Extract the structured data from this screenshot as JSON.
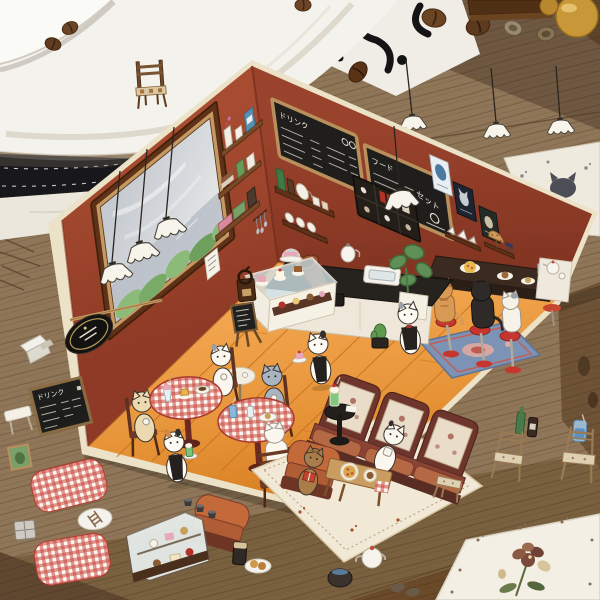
{
  "meta": {
    "type": "photograph",
    "description": "A handmade miniature paper diorama of a cat cafe standing open on a wooden table, surrounded by craft sticker sheets, a large white plate, scattered coffee beans, amber caramels and a black-and-white patterned cloth."
  },
  "diorama": {
    "menu_boards": {
      "drinks_title": "ドリンク",
      "food_title": "フード",
      "set_title": "セット"
    },
    "wall_color": "#9c4430",
    "floor_color": "#e59b3f",
    "card_edge_color": "#efe6cf",
    "left_wall_items": [
      "large window with garden view",
      "three frilled pendant lamps",
      "three wall shelves with books, jars and bottles",
      "black oval coffee sign",
      "small menu paper",
      "hanging utensil rack",
      "leaning wooden rod"
    ],
    "back_wall_items": [
      "two chalkboard menus",
      "shelf with bottles and jug",
      "shelf with cups",
      "dark display cabinet",
      "frilled pendant lamp",
      "three posters",
      "shelf with open books",
      "shelf with table lamp and books"
    ],
    "furniture": [
      "L-shaped service counter with sink",
      "cake display case",
      "gramophone",
      "coffee grinder",
      "monstera plant in white pot",
      "small cactus",
      "standing easel chalkboard",
      "two round tables with red gingham cloth",
      "small white cloth table",
      "wooden chairs",
      "bar counter with red stools",
      "blue floral rug",
      "high-back booth sofa",
      "two orange armchairs",
      "black round side table with melon cream soda",
      "wooden coffee table with pizza",
      "cream floral rug"
    ],
    "cats": [
      {
        "spot": "behind counter",
        "look": "white cat waiter with dark apron"
      },
      {
        "spot": "center floor",
        "look": "white cat waiter carrying a cake tray"
      },
      {
        "spot": "left floor",
        "look": "calico cat waiter carrying a melon soda tray"
      },
      {
        "spot": "left gingham table",
        "look": "cream cat drinking from a cup"
      },
      {
        "spot": "left gingham table",
        "look": "white cat with grey patches having coffee"
      },
      {
        "spot": "small white table",
        "look": "grey-blue cat eating dessert"
      },
      {
        "spot": "right gingham table",
        "look": "white cat seen from behind on a wooden chair"
      },
      {
        "spot": "bar counter",
        "look": "orange tabby cat on a red stool"
      },
      {
        "spot": "bar counter",
        "look": "black cat on a red stool"
      },
      {
        "spot": "bar counter",
        "look": "white-and-grey cat on a red stool"
      },
      {
        "spot": "booth sofa",
        "look": "white cat drinking from a mug"
      },
      {
        "spot": "orange armchair",
        "look": "brown tabby cat reading a red book"
      }
    ]
  },
  "stickers": {
    "menu_chalkboard": {
      "title": "ドリンク"
    },
    "around_table": [
      "tiny chair on the plate",
      "three hanging pendant lamps",
      "white sheet with paw prints and cat silhouette",
      "two red gingham placemats",
      "glass cake display case",
      "small green framed picture",
      "small grey cabinet",
      "oval sticker with ladder",
      "three espresso cups",
      "dark glass and pancake plate",
      "white teapot and dark pot",
      "three wooden chairs",
      "green and brown bottles",
      "blue soda glass",
      "white note paper",
      "flower-print sheet",
      "small white table",
      "slippers"
    ]
  },
  "surroundings": {
    "objects": [
      "large white plate",
      "white saucer edge",
      "scattered coffee beans",
      "black-and-white patterned cloth",
      "wooden box edge",
      "amber caramel candies",
      "wooden table surface"
    ]
  },
  "colors": {
    "wall": "#9c4430",
    "floor": "#e59b3f",
    "card_edge": "#efe6cf",
    "table_wood": "#8a7054",
    "gingham_red": "#c8453c",
    "booth_red": "#6e352c",
    "rug_blue": "#7c93b5",
    "stool_red": "#c6362e",
    "plate_white": "#f4f2ec"
  }
}
